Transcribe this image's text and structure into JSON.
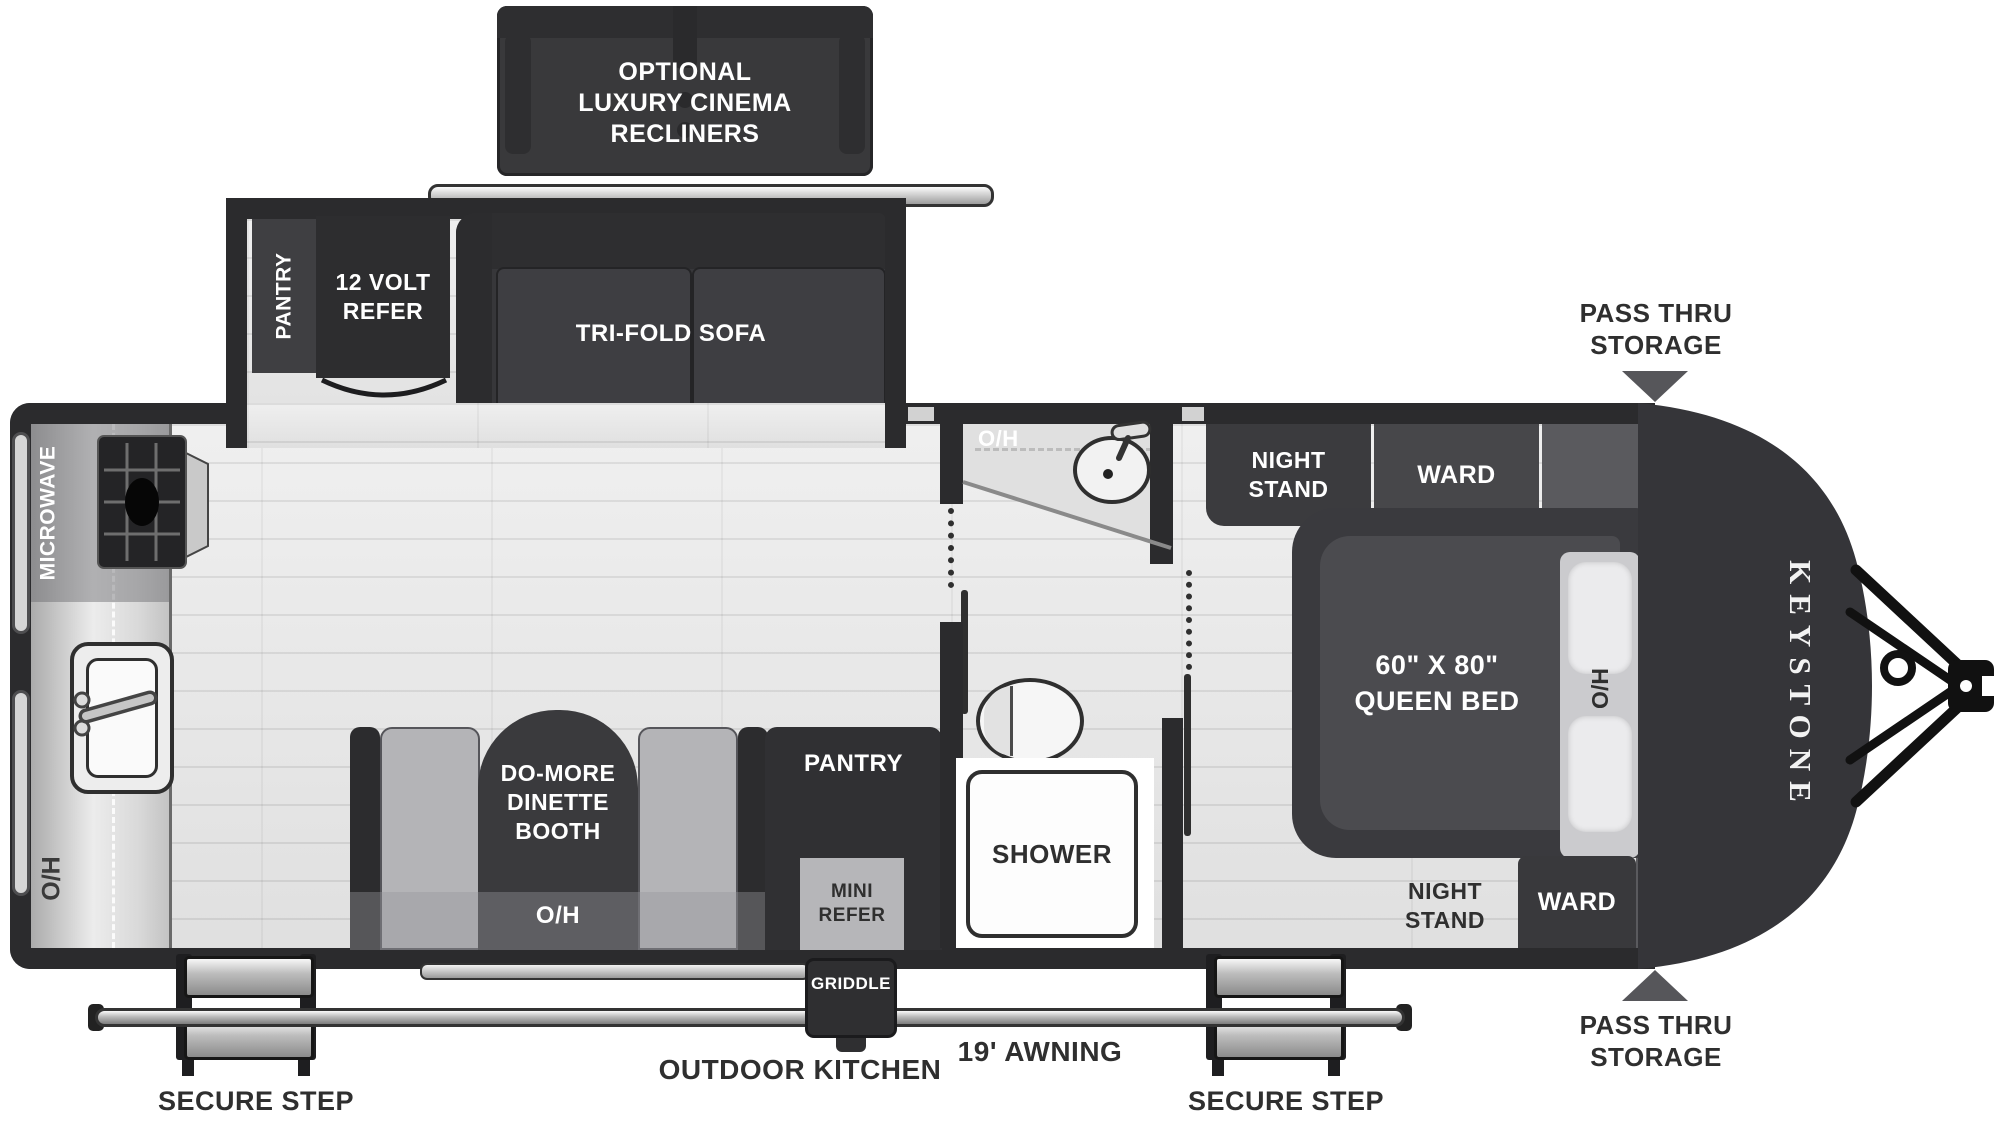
{
  "optional_recliners": {
    "lines": [
      "OPTIONAL",
      "LUXURY CINEMA",
      "RECLINERS"
    ]
  },
  "slideout": {
    "pantry": "PANTRY",
    "refer_lines": [
      "12 VOLT",
      "REFER"
    ],
    "sofa": "TRI-FOLD SOFA"
  },
  "kitchen": {
    "microwave": "MICROWAVE",
    "overhead": "O/H"
  },
  "dinette": {
    "name_lines": [
      "DO-MORE",
      "DINETTE",
      "BOOTH"
    ],
    "overhead": "O/H"
  },
  "pantry_wall": {
    "pantry": "PANTRY",
    "mini_refer_lines": [
      "MINI",
      "REFER"
    ]
  },
  "bathroom": {
    "overhead": "O/H",
    "shower": "SHOWER"
  },
  "bedroom": {
    "night_stand_top_lines": [
      "NIGHT",
      "STAND"
    ],
    "ward_top": "WARD",
    "bed_lines": [
      "60\" X 80\"",
      "QUEEN BED"
    ],
    "overhead": "O/H",
    "night_stand_bottom_lines": [
      "NIGHT",
      "STAND"
    ],
    "ward_bottom": "WARD"
  },
  "exterior": {
    "brand": "KEYSTONE",
    "pass_thru_top_lines": [
      "PASS THRU",
      "STORAGE"
    ],
    "pass_thru_bottom_lines": [
      "PASS THRU",
      "STORAGE"
    ],
    "griddle": "GRIDDLE",
    "outdoor_kitchen": "OUTDOOR KITCHEN",
    "awning": "19' AWNING",
    "secure_step_left": "SECURE STEP",
    "secure_step_right": "SECURE STEP"
  },
  "colors": {
    "wall": "#2b2b2d",
    "furniture_dark": "#343437",
    "furniture_mid": "#4b4b4f",
    "floor": "#e7e7e7",
    "counter": "#d8d8d8",
    "label_dark": "#2f2f2f",
    "label_white": "#ffffff",
    "arrow_gray": "#56565a"
  }
}
